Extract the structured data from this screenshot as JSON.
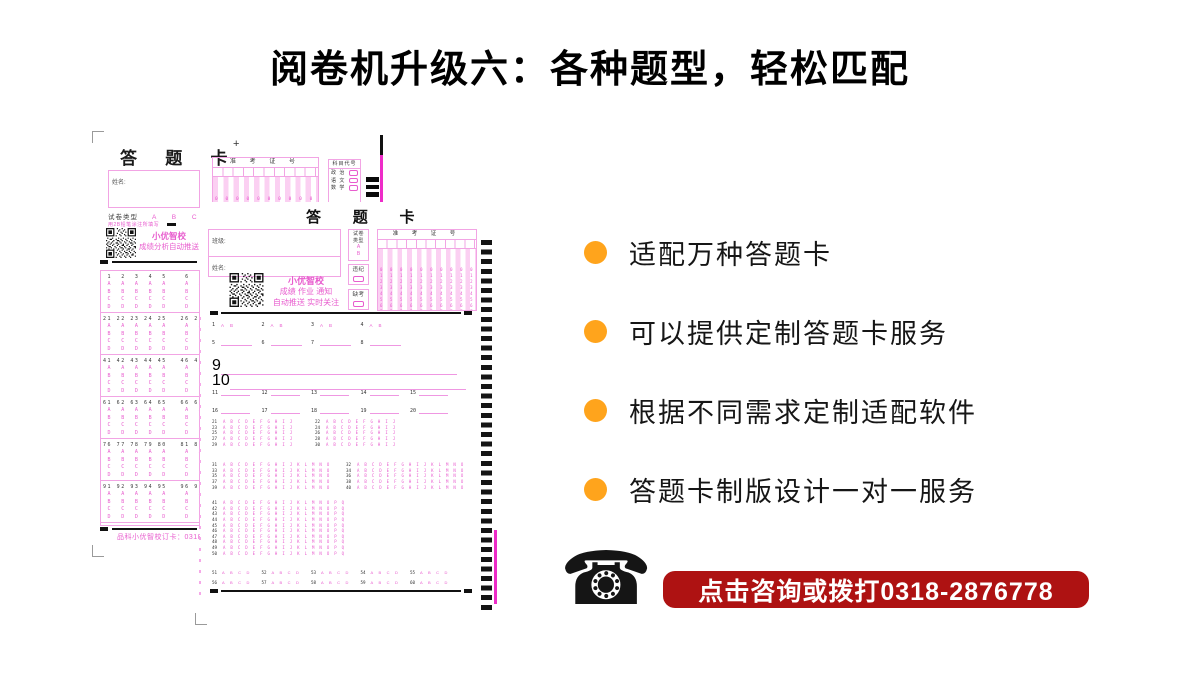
{
  "header": {
    "title": "阅卷机升级六：各种题型，轻松匹配"
  },
  "features": {
    "dot_color": "#FFA41C",
    "items": [
      "适配万种答题卡",
      "可以提供定制答题卡服务",
      "根据不同需求定制适配软件",
      "答题卡制版设计一对一服务"
    ]
  },
  "contact": {
    "phone_icon": "☎",
    "banner_text": "点击咨询或拨打0318-2876778",
    "banner_color": "#AE1212",
    "banner_text_color": "#FFFFFF"
  },
  "shared": {
    "digit_rows": [
      "0 0 0 0 0 0 0 0 0 0",
      "1 1 1 1 1 1 1 1 1 1",
      "2 2 2 2 2 2 2 2 2 2",
      "3 3 3 3 3 3 3 3 3 3",
      "4 4 4 4 4 4 4 4 4 4",
      "5 5 5 5 5 5 5 5 5 5",
      "6 6 6 6 6 6 6 6 6 6",
      "7 7 7 7 7 7 7 7 7 7",
      "8 8 8 8 8 8 8 8 8 8",
      "9 9 9 9 9 9 9 9 9 9"
    ]
  },
  "card_back": {
    "title": "答 题 卡",
    "name_label": "姓名:",
    "plus_mark": "+",
    "exam_header": "准 考 证 号",
    "subject_header": "科目代号",
    "subject_rows": [
      "政 治",
      "语 文",
      "数 学"
    ],
    "paper_type_label": "试卷类型",
    "paper_type_options": "A B C D",
    "pencil_note": "用2B铅笔涂注所填写",
    "qr_caption": [
      "小优智校",
      "成绩分析自动推送"
    ],
    "footer": "品科小优智校订卡：0318-287",
    "blocks": [
      " 1  2  3  4  5    6  7  8",
      "21 22 23 24 25   26 27 28",
      "41 42 43 44 45   46 47 48",
      "61 62 63 64 65   66 67 68",
      "76 77 78 79 80   81 82 83",
      "91 92 93 94 95   96 97 98"
    ],
    "row_a": " A  A  A  A  A    A  A  A",
    "row_b": " B  B  B  B  B    B  B  B",
    "row_c": " C  C  C  C  C    C  C  C",
    "row_d": " D  D  D  D  D    D  D  D"
  },
  "card_front": {
    "title": "答 题 卡",
    "class_label": "班级:",
    "name_label": "姓名:",
    "paper_type": {
      "line1": "试卷",
      "line2": "类型",
      "opt1": "A",
      "opt2": "B"
    },
    "violation_label": "违纪",
    "absent_label": "缺考",
    "exam_header": "准 考 证 号",
    "qr_caption": [
      "小优智校",
      "成绩 作业 通知",
      "自动推送 实时关注"
    ],
    "opts2": "A B",
    "opts4": "A B C D",
    "opts10": "A B C D E F G H I J",
    "opts15": "A B C D E F G H I J K L M N O",
    "opts17": "A B C D E F G H I J K L M N O P Q",
    "q1_4": [
      "1",
      "2",
      "3",
      "4"
    ],
    "q5_8": [
      "5",
      "6",
      "7",
      "8"
    ],
    "q9": "9",
    "q10": "10",
    "q11_15": [
      "11",
      "12",
      "13",
      "14",
      "15"
    ],
    "q16_20": [
      "16",
      "17",
      "18",
      "19",
      "20"
    ],
    "b21": [
      {
        "l": "21",
        "r": "22"
      },
      {
        "l": "23",
        "r": "24"
      },
      {
        "l": "25",
        "r": "26"
      },
      {
        "l": "27",
        "r": "28"
      },
      {
        "l": "29",
        "r": "30"
      }
    ],
    "b31": [
      {
        "l": "31",
        "r": "32"
      },
      {
        "l": "33",
        "r": "34"
      },
      {
        "l": "35",
        "r": "36"
      },
      {
        "l": "37",
        "r": "38"
      },
      {
        "l": "39",
        "r": "40"
      }
    ],
    "b41": [
      "41",
      "42",
      "43",
      "44",
      "45",
      "46",
      "47",
      "48",
      "49",
      "50"
    ],
    "b51": [
      "51",
      "52",
      "53",
      "54",
      "55"
    ],
    "b56": [
      "56",
      "57",
      "58",
      "59",
      "60"
    ]
  }
}
